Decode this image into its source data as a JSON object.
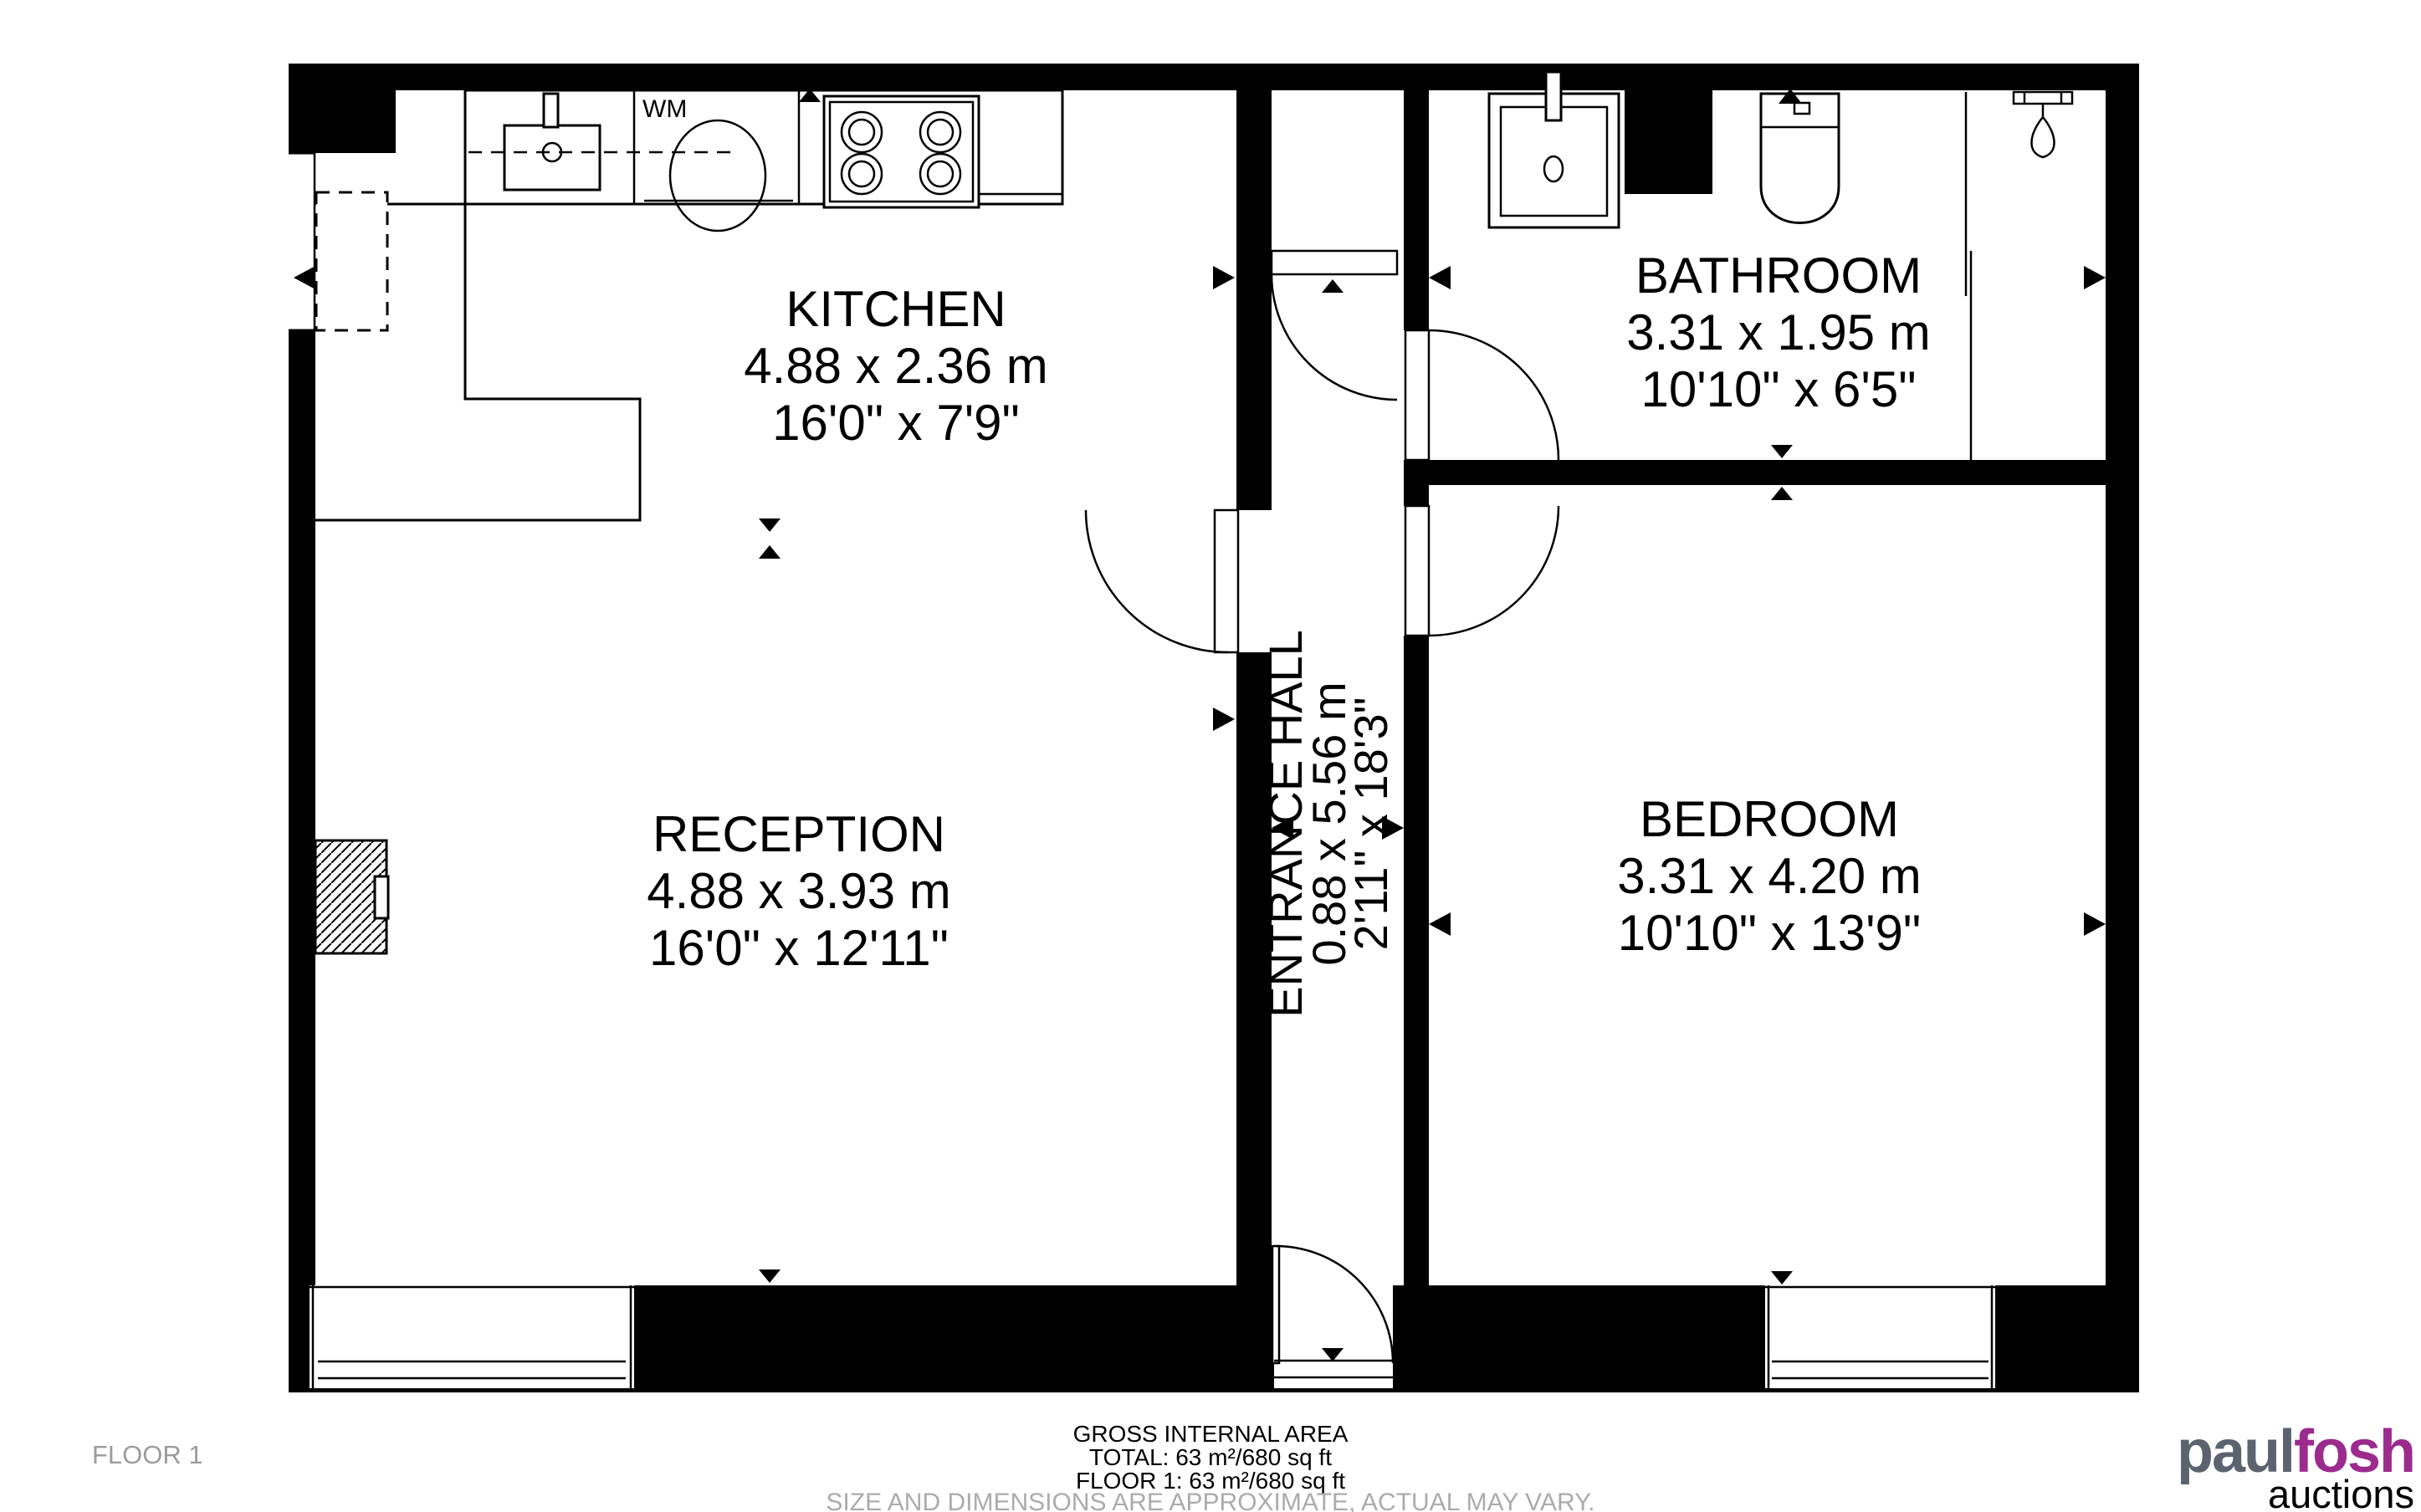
{
  "floorplan": {
    "rooms": [
      {
        "id": "kitchen",
        "name": "KITCHEN",
        "metric": "4.88 x 2.36 m",
        "imperial": "16'0\" x 7'9\""
      },
      {
        "id": "reception",
        "name": "RECEPTION",
        "metric": "4.88 x 3.93 m",
        "imperial": "16'0\" x 12'11\""
      },
      {
        "id": "entrance-hall",
        "name": "ENTRANCE HALL",
        "metric": "0.88 x 5.56 m",
        "imperial": "2'11\" x 18'3\""
      },
      {
        "id": "bathroom",
        "name": "BATHROOM",
        "metric": "3.31 x 1.95 m",
        "imperial": "10'10\" x 6'5\""
      },
      {
        "id": "bedroom",
        "name": "BEDROOM",
        "metric": "3.31 x 4.20 m",
        "imperial": "10'10\" x 13'9\""
      }
    ],
    "labels": {
      "washing_machine": "WM"
    }
  },
  "footer": {
    "floor_label": "FLOOR 1",
    "area_title": "GROSS INTERNAL AREA",
    "area_total": "TOTAL: 63 m²/680 sq ft",
    "area_floor1": "FLOOR 1: 63 m²/680 sq ft",
    "disclaimer": "SIZE AND DIMENSIONS ARE APPROXIMATE, ACTUAL MAY VARY."
  },
  "logo": {
    "part1": "paul",
    "part2": "fosh",
    "part3": "auctions",
    "gray": "#5b646e",
    "purple": "#9c2b8e"
  },
  "colors": {
    "wall": "#000000",
    "background": "#ffffff",
    "muted_text": "#ababab"
  }
}
